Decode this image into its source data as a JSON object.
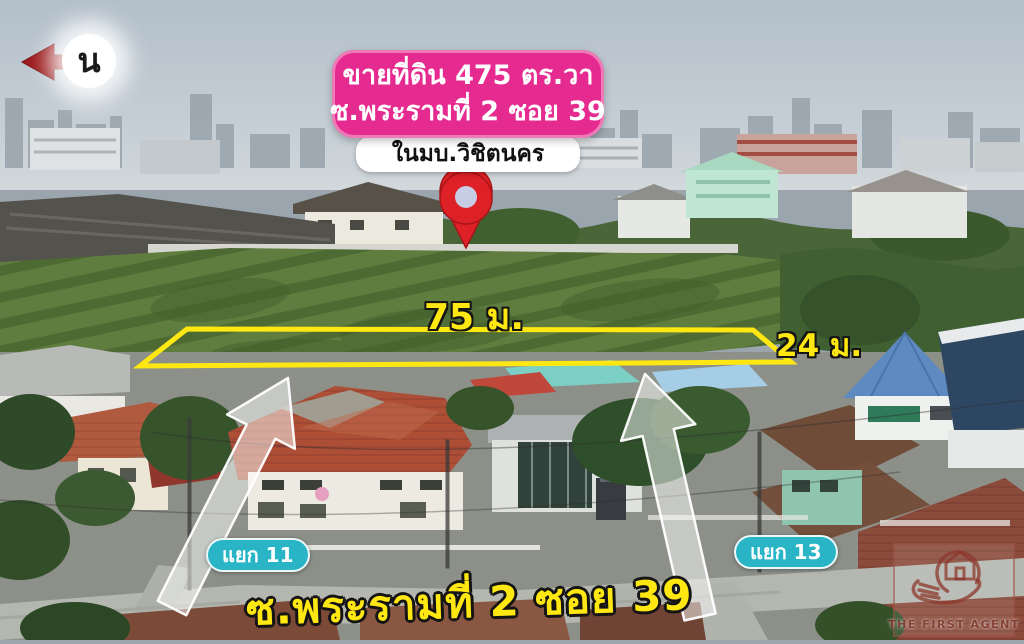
{
  "compass": {
    "letter": "น"
  },
  "sale_banner": {
    "line1": "ขายที่ดิน 475 ตร.วา",
    "line2": "ซ.พระรามที่ 2 ซอย 39"
  },
  "village_banner": {
    "label": "ในมบ.วิชิตนคร"
  },
  "plot_labels": {
    "width": "75 ม.",
    "depth": "24 ม."
  },
  "junctions": {
    "left": "แยก 11",
    "right": "แยก 13"
  },
  "road_label": "ซ.พระรามที่ 2 ซอย 39",
  "watermark": {
    "brand": "THE FIRST AGENT"
  },
  "colors": {
    "banner_pink": "#e62b90",
    "highlight_yellow": "#ffe712",
    "badge_teal": "#29b5c5",
    "pin_red": "#dd2127",
    "compass_arrow_red": "#9c1a1c",
    "watermark_maroon": "#9c4a3c"
  }
}
